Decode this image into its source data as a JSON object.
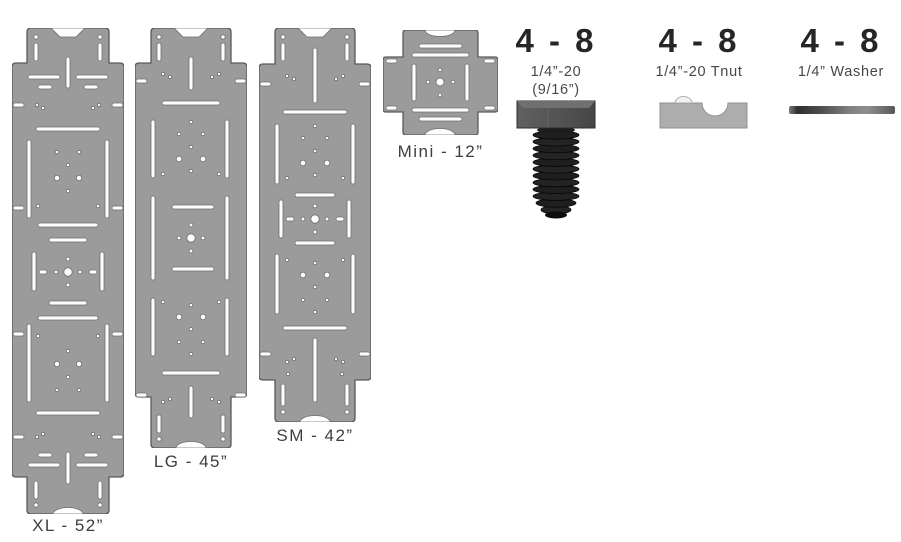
{
  "plates": [
    {
      "id": "xl",
      "label": "XL - 52”"
    },
    {
      "id": "lg",
      "label": "LG - 45”"
    },
    {
      "id": "sm",
      "label": "SM - 42”"
    },
    {
      "id": "mini",
      "label": "Mini - 12”"
    }
  ],
  "hardware": [
    {
      "id": "bolt",
      "quantity": "4 - 8",
      "name_line1": "1/4”-20",
      "name_line2": "(9/16”)"
    },
    {
      "id": "tnut",
      "quantity": "4 - 8",
      "name_line1": "1/4”-20 Tnut",
      "name_line2": ""
    },
    {
      "id": "washer",
      "quantity": "4 - 8",
      "name_line1": "1/4” Washer",
      "name_line2": ""
    }
  ],
  "colors": {
    "plate_fill": "#9b9b9b",
    "plate_outline": "#5a5a5a",
    "cutout_fill": "#fdfdfd",
    "cutout_outline": "#6e6e6e",
    "label_text": "#3e3e3e",
    "quantity_text": "#262626",
    "bolt_dark": "#1f1f1f",
    "tnut_gray": "#adadad"
  }
}
